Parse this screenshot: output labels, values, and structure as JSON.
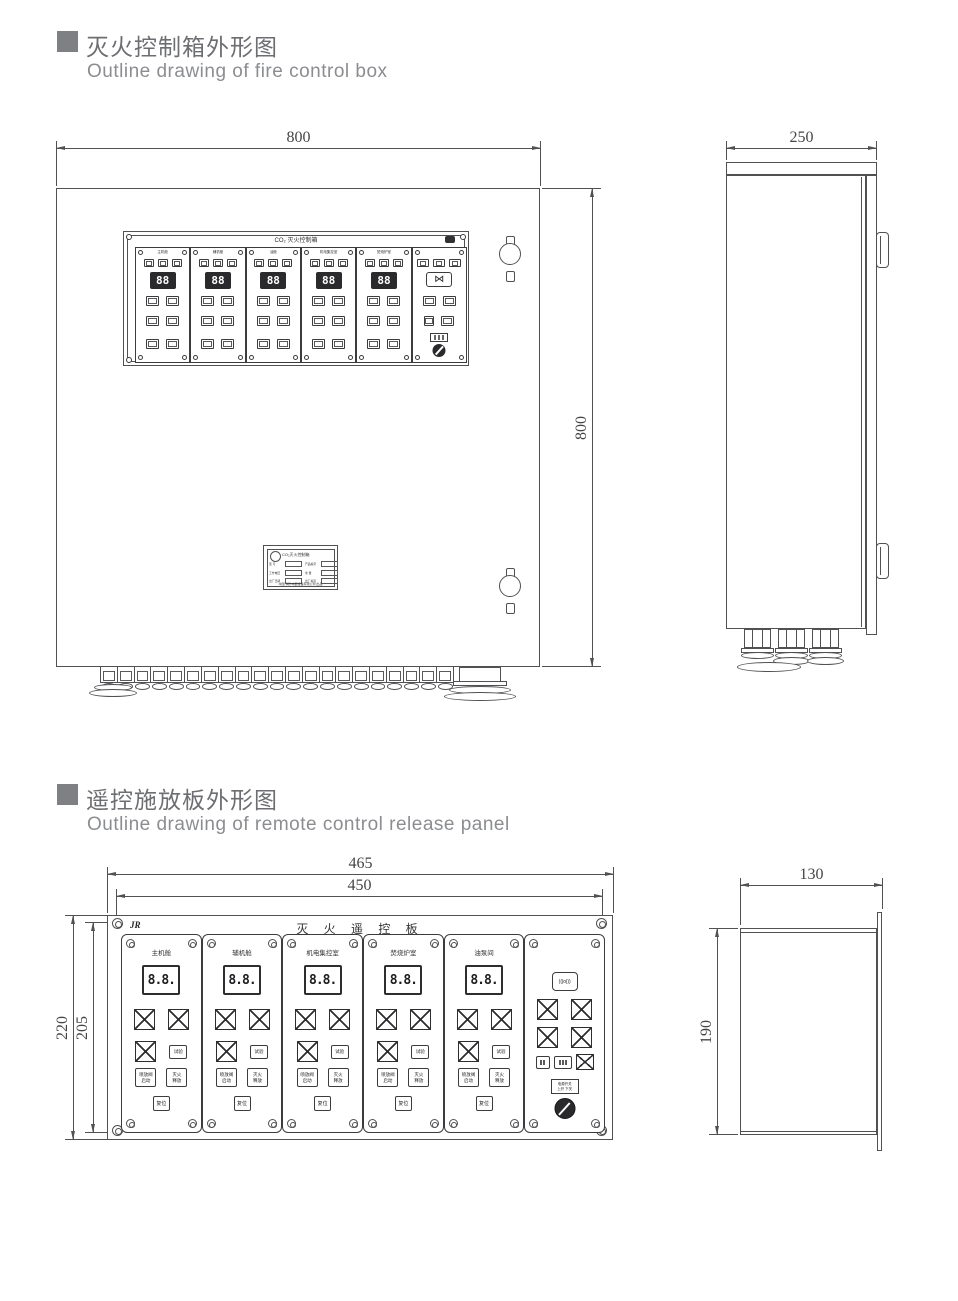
{
  "heading1": {
    "zh": "灭火控制箱外形图",
    "en": "Outline drawing of fire control box"
  },
  "heading2": {
    "zh": "遥控施放板外形图",
    "en": "Outline drawing of remote control release panel"
  },
  "icons": {
    "bowtie": "⋈",
    "horn": "((|o|))",
    "brand": "JR"
  },
  "control_box": {
    "front": {
      "width_dim": "800",
      "height_dim": "800",
      "panel_title": "CO₂ 灭火控制箱",
      "display_value": "88",
      "zones": [
        {
          "label": "主机舱"
        },
        {
          "label": "辅机舱"
        },
        {
          "label": "油舱"
        },
        {
          "label": "机电集控室"
        },
        {
          "label": "焚烧炉室"
        }
      ],
      "nameplate": {
        "title": "CO₂灭火控制箱",
        "fields_left": [
          "型 号",
          "工作电压",
          "出厂日期"
        ],
        "fields_right": [
          "产品编号",
          "重 量",
          "出厂编号"
        ],
        "footer": "中国·消防电器设备有限公司 出品"
      }
    },
    "side": {
      "depth_dim": "250"
    }
  },
  "remote_panel": {
    "front": {
      "outer_width_dim": "465",
      "mount_width_dim": "450",
      "outer_height_dim": "220",
      "mount_height_dim": "205",
      "title": "灭 火 遥 控 板",
      "display_value": "8.8.",
      "zones": [
        "主机舱",
        "辅机舱",
        "机电集控室",
        "焚烧炉室",
        "油泵间"
      ],
      "buttons": {
        "test": "试验",
        "valve": [
          "喷放阀",
          "启动"
        ],
        "release": [
          "灭火",
          "释放"
        ],
        "reset": "复位"
      },
      "common": {
        "power_plate_line1": "电源开关",
        "power_plate_line2": "上开 下关"
      }
    },
    "side": {
      "width_dim": "130",
      "height_dim": "190"
    }
  }
}
